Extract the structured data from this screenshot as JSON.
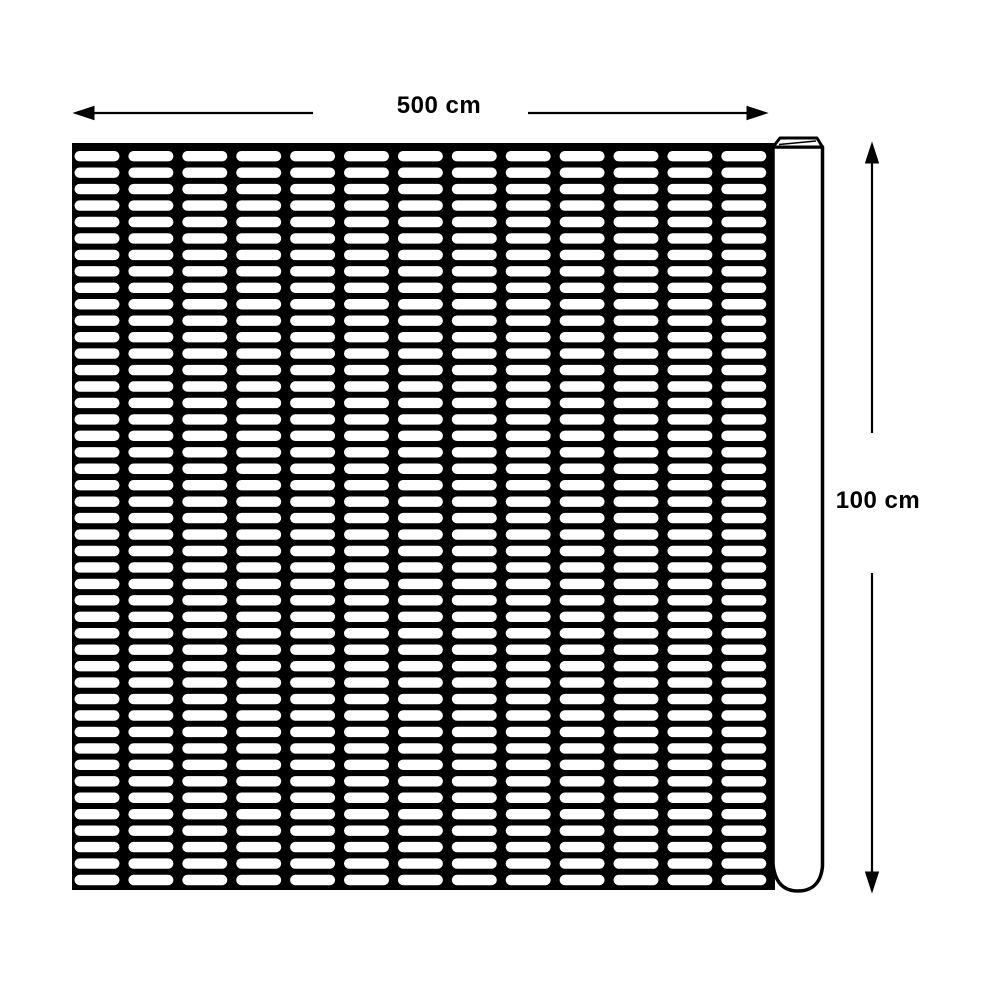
{
  "diagram": {
    "type": "product-dimension-drawing",
    "subject": "plastic-mesh-barrier-fence-roll",
    "dimensions": {
      "width": {
        "label": "500 cm"
      },
      "height": {
        "label": "100 cm"
      }
    },
    "mesh": {
      "columns": 13,
      "rows": 45
    },
    "colors": {
      "ink": "#000000",
      "background": "#ffffff",
      "slot_fill": "#ffffff"
    }
  }
}
